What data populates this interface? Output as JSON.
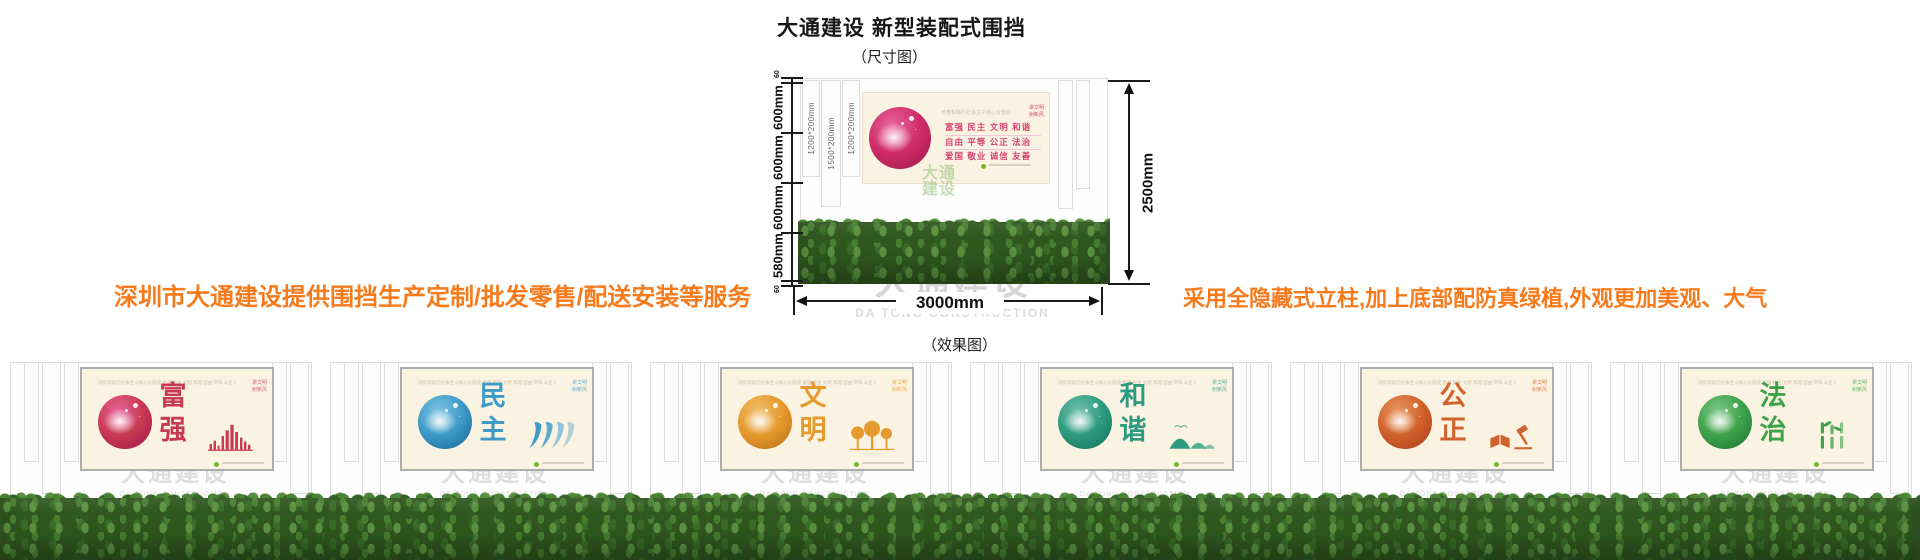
{
  "title": "大通建设 新型装配式围挡",
  "size_caption": "（尺寸图）",
  "effect_caption": "（效果图）",
  "notes": {
    "left": "深圳市大通建设提供围挡生产定制/批发零售/配送安装等服务",
    "right": "采用全隐藏式立柱,加上底部配防真绿植,外观更加美观、大气",
    "color": "#F77B1C"
  },
  "watermark": {
    "cn": "大通建设",
    "en": "DA TONG CONSTRUCTION"
  },
  "logo_watermark": {
    "line1": "大通",
    "line2": "建设",
    "color": "#9CC07A"
  },
  "diagram": {
    "left_dims": [
      "60",
      "600mm",
      "600mm",
      "600mm",
      "580mm",
      "60"
    ],
    "right_dim": "2500mm",
    "bottom_dim": "3000mm",
    "post_labels": [
      "1200*200mm",
      "1500*200mm",
      "1200*200mm"
    ],
    "poster": {
      "header": "培育和践行社会主义核心价值观",
      "slogan_top": "讲文明",
      "slogan_bottom": "树新风",
      "rows": [
        "富强 民主 文明 和谐",
        "自由 平等 公正 法治",
        "爱国 敬业 诚信 友善"
      ],
      "text_color": "#D54372",
      "bg": "#FBF3E2"
    }
  },
  "panel_common": {
    "header": "培育和践行社会主义核心价值观  富强 民主 文明 和谐 自由 平等 公正 法治 爱国 敬业 诚信 友善",
    "slogan_top": "讲文明",
    "slogan_bottom": "树新风"
  },
  "panels": [
    {
      "word": "富强",
      "color": "#C93A52",
      "light": "#E8659A",
      "dark": "#A81C4C"
    },
    {
      "word": "民主",
      "color": "#3E9BC8",
      "light": "#7EC3E2",
      "dark": "#1F6FA0"
    },
    {
      "word": "文明",
      "color": "#E59A2E",
      "light": "#F2BE6A",
      "dark": "#C0761A"
    },
    {
      "word": "和谐",
      "color": "#2E9B81",
      "light": "#6FC2A9",
      "dark": "#157A63"
    },
    {
      "word": "公正",
      "color": "#D2622B",
      "light": "#E99560",
      "dark": "#B0441C"
    },
    {
      "word": "法治",
      "color": "#3EA24B",
      "light": "#7CC687",
      "dark": "#1F7F35"
    }
  ],
  "grass_color": "#30571f",
  "fence_color": "#fefefe"
}
